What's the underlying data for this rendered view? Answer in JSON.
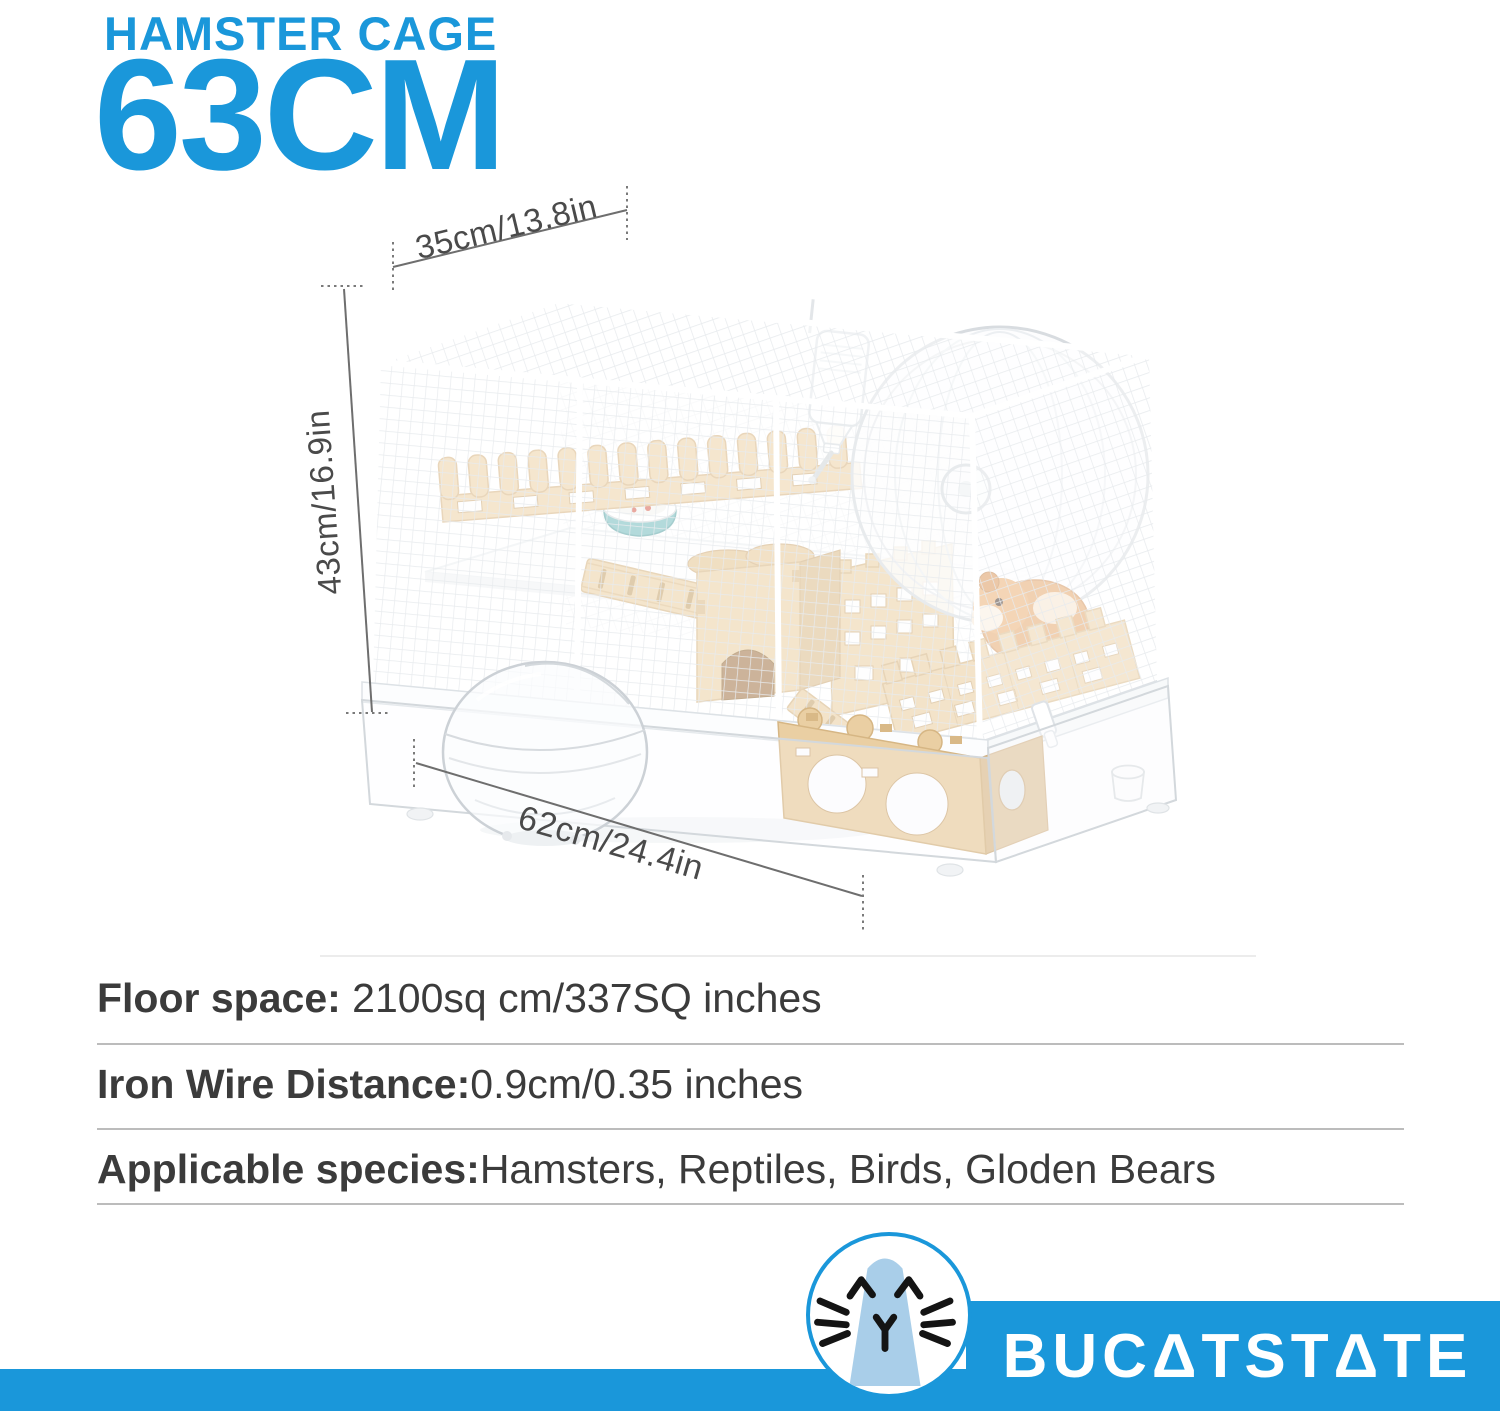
{
  "header": {
    "kicker": "HAMSTER CAGE",
    "headline": "63CM"
  },
  "dimension_labels": {
    "top_width": "35cm/13.8in",
    "side_height": "43cm/16.9in",
    "bottom_depth": "62cm/24.4in"
  },
  "specs": {
    "rows": [
      {
        "label": "Floor space:",
        "value": " 2100sq cm/337SQ inches"
      },
      {
        "label": "Iron Wire Distance:",
        "value": "0.9cm/0.35 inches"
      },
      {
        "label": "Applicable species:",
        "value": "Hamsters, Reptiles, Birds, Gloden Bears"
      }
    ]
  },
  "footer": {
    "brand_name": "BUCATSTATE",
    "brand_display": "BUCΔTSTΔTE"
  },
  "illustration": {
    "alt": "Two-tier hamster cage: white wire top with wooden castle fences, exercise wheel, water bottle, food bowl, wooden arch house and ladders; clear acrylic base bin with round sand bath and wooden hideout house with circular holes",
    "icons": [
      "wire-cage",
      "clear-base-bin",
      "water-bottle",
      "exercise-wheel",
      "food-bowl",
      "wood-fence",
      "wood-castle",
      "wood-ladder",
      "hamster",
      "sand-bath",
      "wood-hideout-house",
      "latch-clip",
      "cat-logo"
    ]
  },
  "colors": {
    "brand_blue": "#1a97da",
    "logo_light_blue": "#a9cee9",
    "logo_ink": "#141414",
    "wood": "#eed5ab",
    "wood_shade": "#ddbf92",
    "wood_line": "#c9a873",
    "teal_bowl": "#7cc0c2",
    "hamster_fur": "#e3a264",
    "text_dark": "#3b3b3b",
    "dimension_line": "#6e6e6e",
    "divider": "#bcbcbc",
    "mesh": "#e8ebee",
    "plastic_line": "#d3d8dc"
  }
}
